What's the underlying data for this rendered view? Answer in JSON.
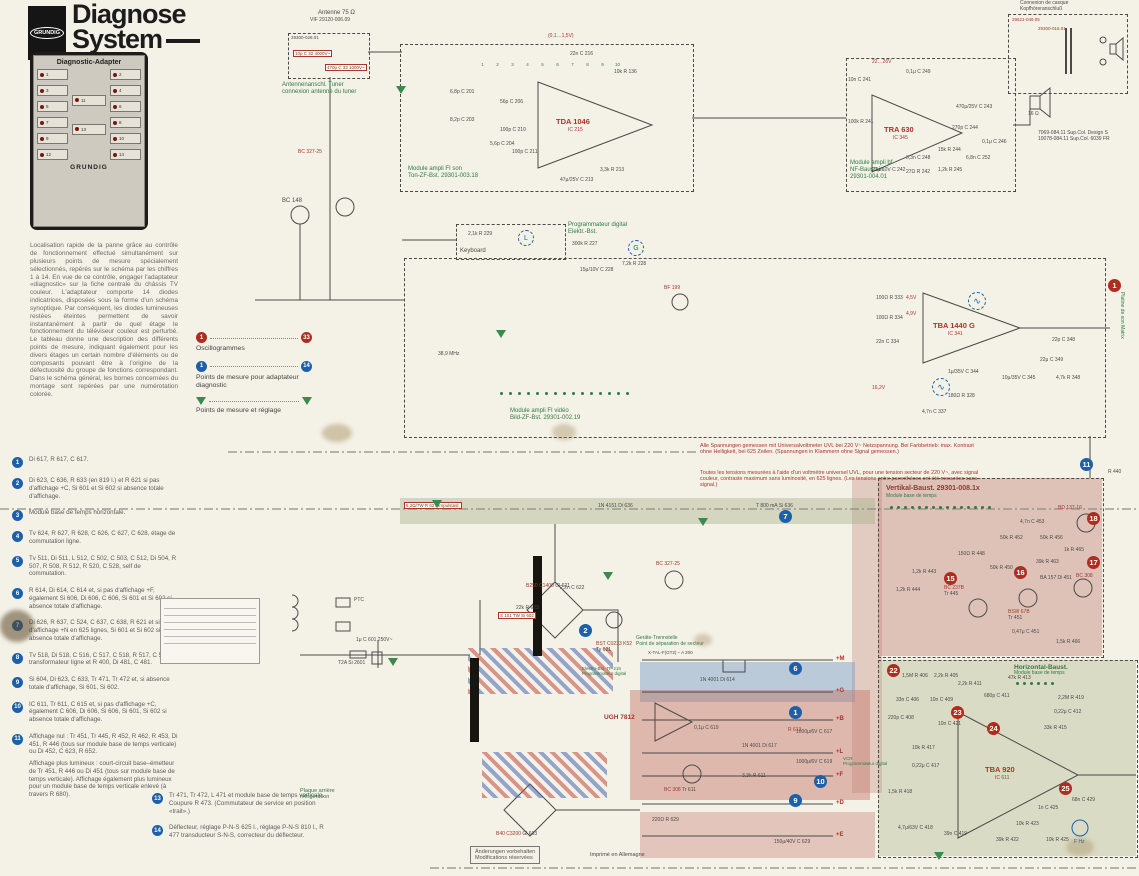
{
  "header": {
    "brand": "GRUNDIG",
    "title1": "Diagnose",
    "title2": "System"
  },
  "adapter": {
    "title": "Diagnostic-Adapter",
    "brand": "GRUNDIG",
    "left": [
      "1",
      "3",
      "5",
      "7",
      "9",
      "12"
    ],
    "right": [
      "2",
      "4",
      "6",
      "8",
      "10",
      "14"
    ],
    "center": [
      "11",
      "13"
    ]
  },
  "intro": {
    "text": "Localisation rapide de la panne grâce au contrôle de fonctionnement effectué simultanément sur plusieurs points de mesure spécialement sélectionnés, repérés sur le schéma par les chiffres 1 à 14. En vue de ce contrôle, engager l'adaptateur «diagnostic» sur la fiche centrale du châssis TV couleur. L'adaptateur comporte 14 diodes indicatrices, disposées sous la forme d'un schéma synoptique. Par conséquent, les diodes lumineuses restées éteintes permettent de savoir instantanément à partir de quel étage le fonctionnement du téléviseur couleur est perturbé. Le tableau donne une description des différents points de mesure, indiquant également pour les divers étages un certain nombre d'éléments ou de composants pouvant être à l'origine de la défectuosité du groupe de fonctions correspondant. Dans le schéma général, les bornes concernées du montage sont repérées par une numérotation colorée."
  },
  "legend": {
    "osc_from": "1",
    "osc_to": "33",
    "osc_label": "Oscillogrammes",
    "ad_from": "1",
    "ad_to": "14",
    "ad_label": "Points de mesure pour adaptateur diagnostic",
    "adj_label": "Points de mesure et réglage"
  },
  "points": {
    "items": [
      {
        "n": "1",
        "text": "Di 617, R 617, C 617."
      },
      {
        "n": "2",
        "text": "Di 623, C 636, R 633 (en 819 l.) et R 621 si pas d'affichage +C, Si 601 et Si 602 si absence totale d'affichage."
      },
      {
        "n": "3",
        "text": "Module base de temps horizontale."
      },
      {
        "n": "4",
        "text": "Tv 624, R 627, R 628, C 626, C 627, C 628, étage de commutation ligne."
      },
      {
        "n": "5",
        "text": "Tv 511, Di 511, L 512, C 502, C 503, C 512, Di 504, R 507, R 508, R 512, R 520, C 528, self de commutation."
      },
      {
        "n": "6",
        "text": "R 614, Di 614, C 614 et, si pas d'affichage +F, également Si 606, Di 606, C 606, Si 601 et Si 602 si absence totale d'affichage."
      },
      {
        "n": "7",
        "text": "Di 626, R 637, C 524, C 637, C 638, R 621 et si pas d'affichage +N en 625 lignes, Si 601 et Si 602 si absence totale d'affichage."
      },
      {
        "n": "8",
        "text": "Tv 518, Di 518, C 516, C 517, C 518, R 517, C 537, transformateur ligne et R 400, Di 481, C 481."
      },
      {
        "n": "9",
        "text": "Si 604, Di 623, C 633, Tr 471, Tr 472 et, si absence totale d'affichage, Si 601, Si 602."
      },
      {
        "n": "10",
        "text": "IC 611, Tr 611, C 615 et, si pas d'affichage +C, également C 606, Di 606, Si 606, Si 601, Si 602 si absence totale d'affichage."
      },
      {
        "n": "11",
        "text": "Affichage nul : Tr 451, Tr 445, R 452, R 462, R 453, Di 451, R 446 (tous sur module base de temps verticale) ou Di 452, C 623, R 652.",
        "text2": "Affichage plus lumineux : court-circuit base–émetteur de Tr 451, R 446 ou Di 451 (tous sur module base de temps verticale). Affichage également plus lumineux pour un module base de temps verticale enlevé (à travers R 680)."
      }
    ],
    "items2": [
      {
        "n": "13",
        "text": "Tr 471, Tr 472, L 471 et module base de temps verticale. Coupure R 473. (Commutateur de service en position «trait».)"
      },
      {
        "n": "14",
        "text": "Déflecteur, réglage P-N-S 625 l., réglage P-N-S 810 l., R 477 transducteur S-N-S, correcteur du déflecteur."
      }
    ]
  },
  "modules": {
    "antenna": {
      "top1": "Antenne 75 Ω",
      "top2": "VIF 29120-006.09",
      "ref": "29300-028.01",
      "c32": "10p C 32 4000V~",
      "c33": "470p C 33 1000V~",
      "cap1": "Antennenanschl. Tuner",
      "cap2": "connexion antenne du tuner"
    },
    "sound_if": {
      "cap1": "Module ampli FI son",
      "cap2": "Ton-ZF-Bst. 29301-003.18",
      "ic": "TDA 1046",
      "icref": "IC 215",
      "volt": "(0,1…1,5V)",
      "parts": [
        {
          "t": "6,8p C 201"
        },
        {
          "t": "8,2p C 203"
        },
        {
          "t": "5,6p C 204"
        },
        {
          "t": "56p C 206"
        },
        {
          "t": "100p C 211"
        },
        {
          "t": "100p C 210"
        },
        {
          "t": "3,3k R 213"
        },
        {
          "t": "47μ/25V C 213"
        },
        {
          "t": "22n C 216"
        },
        {
          "t": "10k R 136"
        }
      ]
    },
    "af": {
      "cap1": "Module ampli bf",
      "cap2": "NF-Baustein",
      "cap3": "29301-004.01",
      "ic": "TRA 630",
      "icref": "IC 345",
      "volt": "22…26V",
      "parts": [
        {
          "t": "10n C 241"
        },
        {
          "t": "100k R 241"
        },
        {
          "t": "0,1μ C 249"
        },
        {
          "t": "470μ/25V C 243"
        },
        {
          "t": "270p C 244"
        },
        {
          "t": "15k R 244"
        },
        {
          "t": "3,3n C 248"
        },
        {
          "t": "22μ/10V C 242"
        },
        {
          "t": "27Ω R 242"
        },
        {
          "t": "1,2k R 245"
        },
        {
          "t": "6,8n C 252"
        },
        {
          "t": "0,1μ C 246"
        }
      ]
    },
    "headphone": {
      "top1": "Connexion de casque",
      "top2": "Kopfhöreranschluß",
      "ref": "29621-049.05",
      "trafo": "29300-016.01",
      "speaker": "16 Ω",
      "cap1": "7069-084.11 Sup.Col. Design S",
      "cap2": "10078-084.11 Sup.Col. 6039 FR"
    },
    "video_if": {
      "cap1": "Module ampli FI vidéo",
      "cap2": "Bild-ZF-Bst. 29301-002.19",
      "ic": "TBA 1440 G",
      "icref": "IC 341",
      "bf": "BF 199",
      "mhz": "38,9 MHz",
      "v1": "4,5V",
      "v2": "4,9V",
      "v3": "16,2V",
      "parts": [
        {
          "t": "100Ω R 333"
        },
        {
          "t": "100Ω R 334"
        },
        {
          "t": "22n C 334"
        },
        {
          "t": "1μ/35V C 344"
        },
        {
          "t": "10μ/35V C 345"
        },
        {
          "t": "22μ C 349"
        },
        {
          "t": "22p C 348"
        },
        {
          "t": "4,7k R 348"
        },
        {
          "t": "180Ω R 328"
        },
        {
          "t": "4,7n C 337"
        }
      ]
    },
    "keyboard": {
      "label": "Keyboard",
      "prog1": "Programmateur digital",
      "prog2": "Elektr.-Bst.",
      "parts": [
        {
          "t": "2,1k R 229"
        },
        {
          "t": "300k R 227"
        },
        {
          "t": "15μ/10V C 228"
        },
        {
          "t": "7,2k R 228"
        }
      ],
      "m1": "L",
      "m2": "G"
    },
    "left_tr": {
      "t1": "BC 148",
      "t2": "BC 327-25"
    },
    "vertical": {
      "title": "Vertikal-Baust. 29301-008.1x",
      "subtitle": "Module base de temps",
      "tr1": "BC 237B",
      "tr1r": "Tr 445",
      "tr2": "BSW 67B",
      "tr2r": "Tr 451",
      "tr3": "BD 137-16",
      "tr4": "BC 308",
      "r440": "R 440",
      "parts": [
        {
          "t": "4,7n C 453"
        },
        {
          "t": "50k R 452"
        },
        {
          "t": "50k R 456"
        },
        {
          "t": "150Ω R 448"
        },
        {
          "t": "50k R 450"
        },
        {
          "t": "39k R 463"
        },
        {
          "t": "1k R 465"
        },
        {
          "t": "1,2k R 443"
        },
        {
          "t": "0,47μ C 451"
        },
        {
          "t": "BA 157 Di 451"
        },
        {
          "t": "1,2k R 444"
        },
        {
          "t": "1,5k R 466"
        }
      ]
    },
    "horizontal": {
      "title": "Horizontal-Baust.",
      "subtitle": "Module base de temps",
      "ic": "TBA 920",
      "icref": "IC 611",
      "trim": "F Hz",
      "parts": [
        {
          "t": "1,5M R 406"
        },
        {
          "t": "2,2k R 405"
        },
        {
          "t": "2,2k R 411"
        },
        {
          "t": "33n C 406"
        },
        {
          "t": "10n C 409"
        },
        {
          "t": "220p C 408"
        },
        {
          "t": "47k R 413"
        },
        {
          "t": "680p C 411"
        },
        {
          "t": "2,2M R 419"
        },
        {
          "t": "0,22μ C 412"
        },
        {
          "t": "33k R 415"
        },
        {
          "t": "10n C 421"
        },
        {
          "t": "10k R 417"
        },
        {
          "t": "0,22μ C 417"
        },
        {
          "t": "1,5k R 418"
        },
        {
          "t": "4,7μ/63V C 418"
        },
        {
          "t": "39n C 419"
        },
        {
          "t": "39k R 422"
        },
        {
          "t": "10k R 423"
        },
        {
          "t": "10k R 425"
        },
        {
          "t": "1n C 425"
        },
        {
          "t": "68n C 429"
        }
      ]
    },
    "power": {
      "ptc": "PTC",
      "fuse": "T2A Si 2601",
      "cap": "1μ C 601 250V~",
      "fuse2": "S 101 TW Si 602",
      "imp": "6,2Ω/7W R 627 Impulstast.",
      "d636": "1N 4151 Di 636",
      "si636": "T 800 mA Si 636",
      "bridge1": "B250 C1400",
      "bridge1r": "Gl 621",
      "c622": "2,2n C 622",
      "r623": "22k R 623",
      "thy": "BST C0233 K52",
      "thyr": "Ty 621",
      "tr": "BC 327-25",
      "reg": "UGH 7812",
      "c619": "0,1μ C 619",
      "tr2": "BC 308",
      "tr2r": "Tr 611",
      "r611": "3,3k R 611",
      "r613": "R 613",
      "d614": "1N 4001 Di 614",
      "d617": "1N 4001 Di 617",
      "c617": "1000μ/6V C 617",
      "c619b": "1000μ/6V C 619",
      "c629": "150μ/40V C 629",
      "r629": "220Ω R 629",
      "bridge2": "B40 C3200",
      "bridge2r": "Gl 603",
      "xtal": "X-TAL-F(GT2) – A 200",
      "rails": [
        {
          "t": "+M"
        },
        {
          "t": "+G"
        },
        {
          "t": "+B"
        },
        {
          "t": "+L"
        },
        {
          "t": "+F"
        },
        {
          "t": "+D"
        },
        {
          "t": "+E"
        }
      ]
    }
  },
  "notes": {
    "volt_de": "Alle Spannungen gemessen mit Universalvoltmeter UVL bei 220 V~ Netzspannung. Bei Farbbetrieb: max. Kontrast ohne Helligkeit, bei 625 Zeilen. (Spannungen in Klammern ohne Signal gemessen.)",
    "volt_fr": "Toutes les tensions mesurées à l'aide d'un voltmètre universel UVL, pour une tension secteur de 220 V~, avec signal couleur, contraste maximum sans luminosité, en 625 lignes. (Les tensions entre parenthèses ont été mesurées sans signal.)",
    "changes_de": "Änderungen vorbehalten",
    "changes_fr": "Modifications réservées",
    "printed": "Imprimé en Allemagne",
    "sep_de": "Geräte-Trennstelle",
    "sep_fr": "Point de séparation de secteur",
    "elbst": "Elektro-Bst. TP 215",
    "elbst2": "Programmateur digital",
    "vcr": "VCR",
    "vcr2": "Programmateur digital",
    "backplate1": "Plaque arrière",
    "backplate2": "réfrigération",
    "matrix": "Platine de son Matrix"
  },
  "markers": {
    "osc1": "1",
    "osc15": "15",
    "osc16": "16",
    "osc17": "17",
    "osc18": "18",
    "osc22": "22",
    "osc23": "23",
    "osc24": "24",
    "osc25": "25",
    "blue1": "1",
    "blue2": "2",
    "blue6": "6",
    "blue7": "7",
    "blue9": "9",
    "blue10": "10",
    "blue11": "11",
    "wave": "∿"
  }
}
